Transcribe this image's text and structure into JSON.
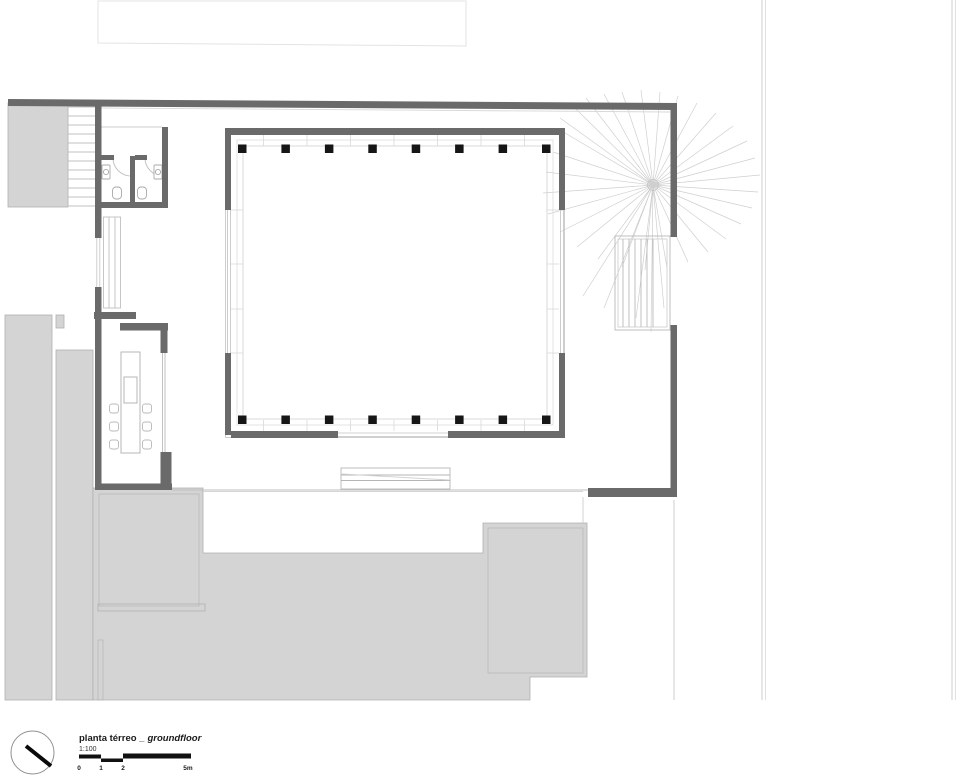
{
  "title_block": {
    "title": "planta térreo _",
    "title_italic": "groundfloor",
    "scale_label": "1:100",
    "scale_bar": {
      "labels": [
        "0",
        "1",
        "2",
        "5m"
      ]
    }
  },
  "palette": {
    "wall": "#6a6a6a",
    "column": "#161616",
    "context_fill": "#d4d4d4",
    "context_stroke": "#b0b0b0",
    "thin_line": "#c4c4c4",
    "tree_line": "#cfcfcf",
    "scale_bar_fill": "#111111"
  },
  "plan": {
    "column_rows": 2,
    "columns_per_row": 8,
    "wc_count": 2,
    "kitchen_chairs": 6,
    "right_stair_treads": 6
  }
}
